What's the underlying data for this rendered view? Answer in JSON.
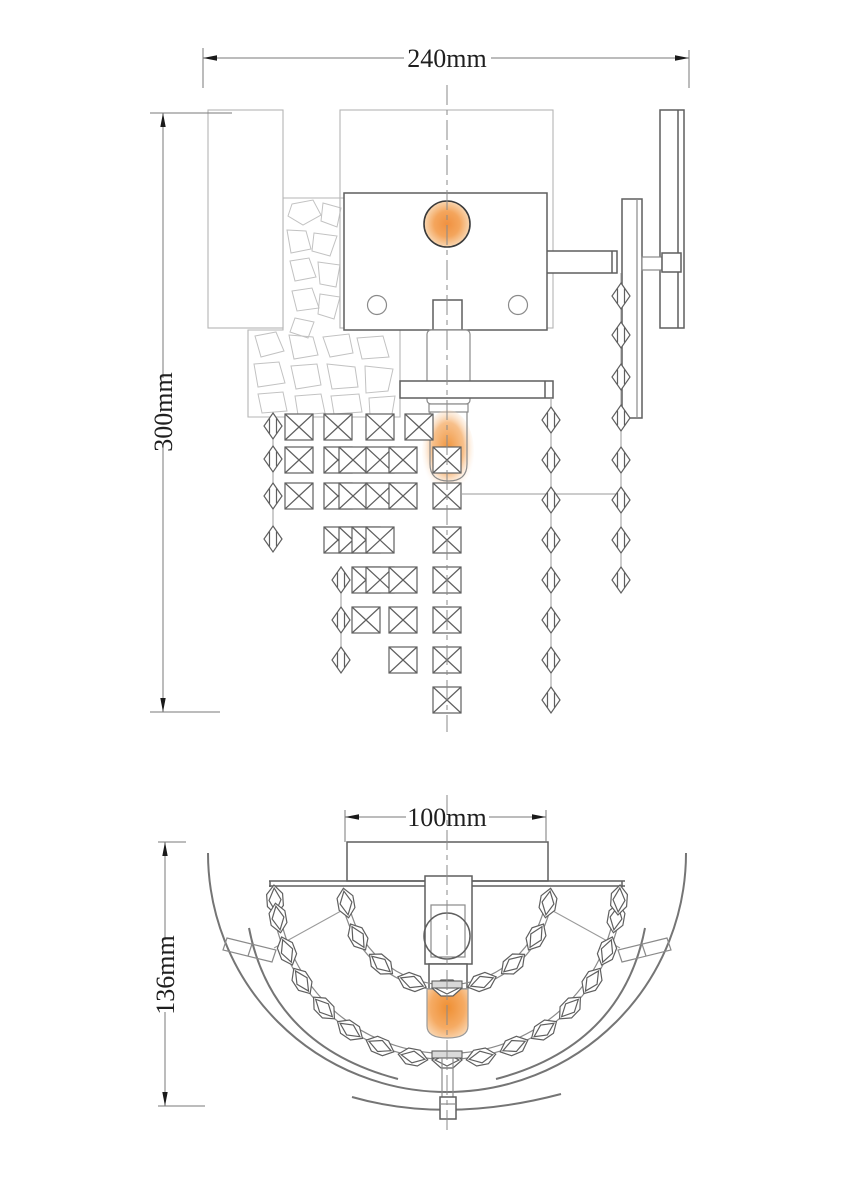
{
  "title": "wall sconce technical drawing",
  "dimensions": {
    "front_width": "240mm",
    "front_height": "300mm",
    "top_width": "100mm",
    "top_depth": "136mm"
  },
  "colors": {
    "line_dark": "#5f5f5f",
    "line_light": "#b5b5b5",
    "glow_core": "#f0923c",
    "glow_mid": "#f5aa60",
    "glow_edge": "#fbe7cf"
  },
  "front_view": {
    "squares": [
      {
        "x": 299,
        "ys": [
          427,
          460,
          496
        ]
      },
      {
        "x": 338,
        "ys": [
          427,
          460,
          496,
          540
        ]
      },
      {
        "x": 353,
        "ys": [
          460,
          496,
          540
        ]
      },
      {
        "x": 366,
        "ys": [
          540,
          580,
          620
        ]
      },
      {
        "x": 380,
        "ys": [
          427,
          460,
          496,
          540,
          580
        ]
      },
      {
        "x": 403,
        "ys": [
          460,
          496,
          580,
          620,
          660
        ]
      },
      {
        "x": 419,
        "ys": [
          427
        ]
      },
      {
        "x": 447,
        "ys": [
          460,
          496,
          540,
          580,
          620,
          660,
          700
        ]
      }
    ],
    "diamonds": [
      {
        "x": 273,
        "ys": [
          426,
          459,
          496,
          539
        ]
      },
      {
        "x": 341,
        "ys": [
          580,
          620,
          660
        ]
      },
      {
        "x": 551,
        "ys": [
          420,
          460,
          500,
          540,
          580,
          620,
          660,
          700
        ]
      },
      {
        "x": 621,
        "ys": [
          296,
          335,
          377,
          418,
          460,
          500,
          540,
          580
        ]
      }
    ],
    "threads": [
      {
        "x1": 273,
        "y1": 415,
        "x2": 273,
        "y2": 548
      },
      {
        "x1": 341,
        "y1": 566,
        "x2": 341,
        "y2": 672
      },
      {
        "x1": 551,
        "y1": 398,
        "x2": 551,
        "y2": 710
      },
      {
        "x1": 621,
        "y1": 273,
        "x2": 621,
        "y2": 590
      },
      {
        "x1": 462,
        "y1": 494,
        "x2": 621,
        "y2": 494
      }
    ]
  },
  "top_view": {
    "outer_garland": [
      {
        "x": 275,
        "y": 900,
        "r": -94
      },
      {
        "x": 278,
        "y": 918,
        "r": -100
      },
      {
        "x": 287,
        "y": 951,
        "r": -111
      },
      {
        "x": 302,
        "y": 981,
        "r": -123
      },
      {
        "x": 324,
        "y": 1008,
        "r": -134
      },
      {
        "x": 350,
        "y": 1030,
        "r": -146
      },
      {
        "x": 380,
        "y": 1046,
        "r": -157
      },
      {
        "x": 413,
        "y": 1057,
        "r": -169
      },
      {
        "x": 447,
        "y": 1060,
        "r": 0
      },
      {
        "x": 481,
        "y": 1057,
        "r": 169
      },
      {
        "x": 514,
        "y": 1046,
        "r": 157
      },
      {
        "x": 544,
        "y": 1030,
        "r": 146
      },
      {
        "x": 570,
        "y": 1008,
        "r": 134
      },
      {
        "x": 592,
        "y": 981,
        "r": 123
      },
      {
        "x": 607,
        "y": 951,
        "r": 111
      },
      {
        "x": 616,
        "y": 918,
        "r": 100
      },
      {
        "x": 619,
        "y": 900,
        "r": 94
      }
    ],
    "inner_garland": [
      {
        "x": 346,
        "y": 903,
        "r": -100
      },
      {
        "x": 358,
        "y": 937,
        "r": -120
      },
      {
        "x": 381,
        "y": 964,
        "r": -140
      },
      {
        "x": 412,
        "y": 982,
        "r": -160
      },
      {
        "x": 447,
        "y": 988,
        "r": 0
      },
      {
        "x": 482,
        "y": 982,
        "r": 160
      },
      {
        "x": 513,
        "y": 964,
        "r": 140
      },
      {
        "x": 536,
        "y": 937,
        "r": 120
      },
      {
        "x": 548,
        "y": 903,
        "r": 100
      }
    ]
  }
}
